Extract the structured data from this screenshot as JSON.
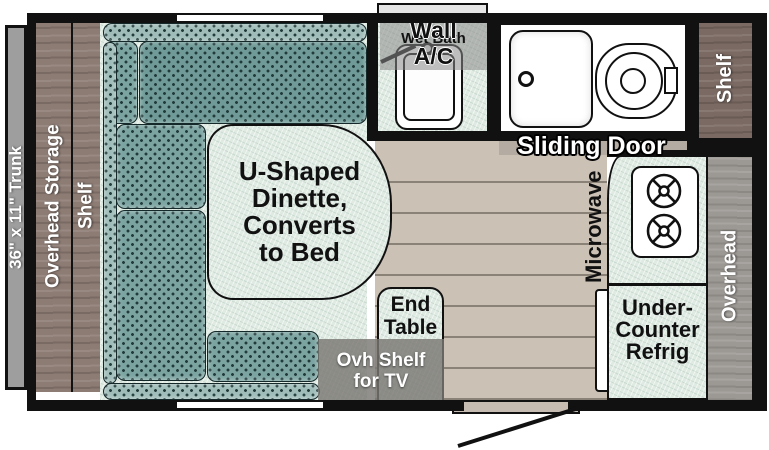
{
  "colors": {
    "wall": "#111111",
    "cushion": "#7ba4a1",
    "cushion-light": "#9fbcb9",
    "cushion-dark": "#6f9a97",
    "cushion-dot": "#213b3b",
    "mint": "#dfeae3",
    "wood": "#8d7c74",
    "wood-dark": "#7b6a63",
    "gray-band": "#9c9894",
    "trunk-gray": "#9e9e9e",
    "floor": "#cbc1b5",
    "floor-line": "#8a8177",
    "door-gray": "#b4aba3",
    "overlay-gray": "rgba(122,119,115,0.82)"
  },
  "storage_left": {
    "trunk": "36\" x 11\" Trunk",
    "overhead_storage": "Overhead Storage",
    "shelf": "Shelf"
  },
  "dinette": {
    "label_lines": [
      "U-Shaped",
      "Dinette,",
      "Converts",
      "to Bed"
    ]
  },
  "wet_bath": {
    "room_label": "Wet Bath",
    "ac_lines": [
      "Wall",
      "A/C"
    ]
  },
  "bath": {
    "sliding_door": "Sliding Door",
    "shelf": "Shelf"
  },
  "kitchen": {
    "microwave": "Microwave",
    "overhead": "Overhead",
    "refrig_lines": [
      "Under-",
      "Counter",
      "Refrig"
    ]
  },
  "living": {
    "end_table_lines": [
      "End",
      "Table"
    ],
    "ovh_shelf_lines": [
      "Ovh Shelf",
      "for TV"
    ]
  }
}
